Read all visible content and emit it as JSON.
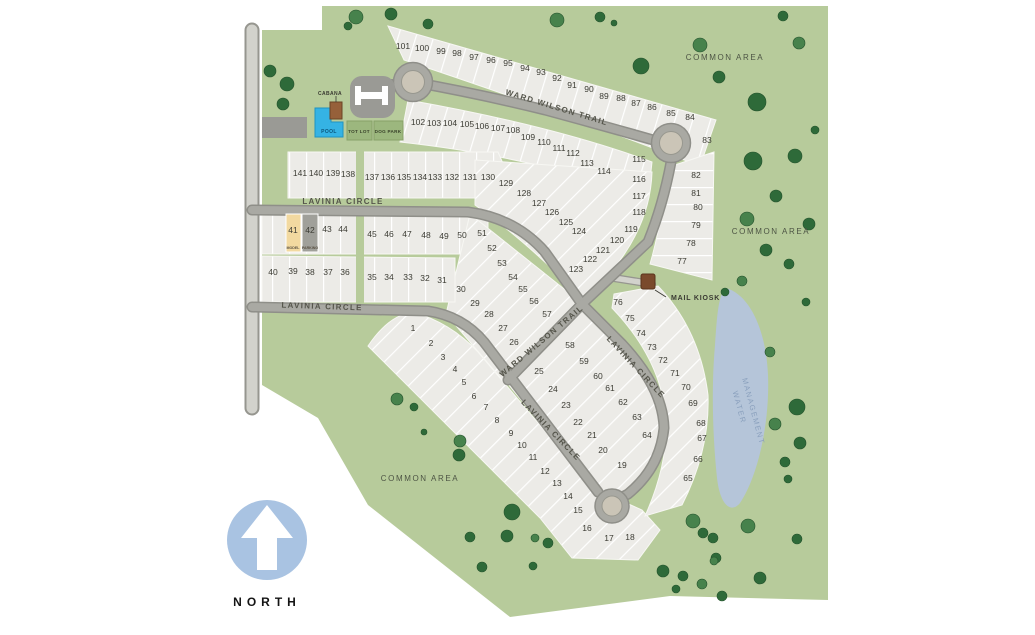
{
  "map": {
    "north_label": "NORTH",
    "streets": [
      {
        "label": "WARD WILSON TRAIL"
      },
      {
        "label": "WARD WILSON TRAIL"
      },
      {
        "label": "LAVINIA CIRCLE"
      },
      {
        "label": "LAVINIA CIRCLE"
      },
      {
        "label": "LAVINIA CIRCLE"
      },
      {
        "label": "LAVINIA CIRCLE"
      }
    ],
    "areas": [
      {
        "label": "COMMON AREA"
      },
      {
        "label": "COMMON AREA"
      },
      {
        "label": "COMMON AREA"
      }
    ],
    "water": {
      "line1": "WATER",
      "line2": "MANAGEMENT"
    },
    "amenities": {
      "cabana": "CABANA",
      "pool": "POOL",
      "tot_lot": "TOT LOT",
      "dog_park": "DOG PARK",
      "mail_kiosk": "MAIL KIOSK"
    },
    "special_lots": {
      "model_label": "MODEL",
      "parking_label": "PARKING"
    },
    "lots_nxy": [
      [
        1,
        413,
        328
      ],
      [
        2,
        431,
        343
      ],
      [
        3,
        443,
        357
      ],
      [
        4,
        455,
        369
      ],
      [
        5,
        464,
        382
      ],
      [
        6,
        474,
        396
      ],
      [
        7,
        486,
        407
      ],
      [
        8,
        497,
        420
      ],
      [
        9,
        511,
        433
      ],
      [
        10,
        522,
        445
      ],
      [
        11,
        533,
        457
      ],
      [
        12,
        545,
        471
      ],
      [
        13,
        557,
        483
      ],
      [
        14,
        568,
        496
      ],
      [
        15,
        578,
        510
      ],
      [
        16,
        587,
        528
      ],
      [
        17,
        609,
        538
      ],
      [
        18,
        630,
        537
      ],
      [
        19,
        622,
        465
      ],
      [
        20,
        603,
        450
      ],
      [
        21,
        592,
        435
      ],
      [
        22,
        578,
        422
      ],
      [
        23,
        566,
        405
      ],
      [
        24,
        553,
        389
      ],
      [
        25,
        539,
        371
      ],
      [
        26,
        514,
        342
      ],
      [
        27,
        503,
        328
      ],
      [
        28,
        489,
        314
      ],
      [
        29,
        475,
        303
      ],
      [
        30,
        461,
        289
      ],
      [
        31,
        442,
        280
      ],
      [
        32,
        425,
        278
      ],
      [
        33,
        408,
        277
      ],
      [
        34,
        389,
        277
      ],
      [
        35,
        372,
        277
      ],
      [
        36,
        345,
        272
      ],
      [
        37,
        328,
        272
      ],
      [
        38,
        310,
        272
      ],
      [
        39,
        293,
        271
      ],
      [
        40,
        273,
        272
      ],
      [
        41,
        293,
        230
      ],
      [
        42,
        310,
        230
      ],
      [
        43,
        327,
        229
      ],
      [
        44,
        343,
        229
      ],
      [
        45,
        372,
        234
      ],
      [
        46,
        389,
        234
      ],
      [
        47,
        407,
        234
      ],
      [
        48,
        426,
        235
      ],
      [
        49,
        444,
        236
      ],
      [
        50,
        462,
        235
      ],
      [
        51,
        482,
        233
      ],
      [
        52,
        492,
        248
      ],
      [
        53,
        502,
        263
      ],
      [
        54,
        513,
        277
      ],
      [
        55,
        523,
        289
      ],
      [
        56,
        534,
        301
      ],
      [
        57,
        547,
        314
      ],
      [
        58,
        570,
        345
      ],
      [
        59,
        584,
        361
      ],
      [
        60,
        598,
        376
      ],
      [
        61,
        610,
        388
      ],
      [
        62,
        623,
        402
      ],
      [
        63,
        637,
        417
      ],
      [
        64,
        647,
        435
      ],
      [
        65,
        688,
        478
      ],
      [
        66,
        698,
        459
      ],
      [
        67,
        702,
        438
      ],
      [
        68,
        701,
        423
      ],
      [
        69,
        693,
        403
      ],
      [
        70,
        686,
        387
      ],
      [
        71,
        675,
        373
      ],
      [
        72,
        663,
        360
      ],
      [
        73,
        652,
        347
      ],
      [
        74,
        641,
        333
      ],
      [
        75,
        630,
        318
      ],
      [
        76,
        618,
        302
      ],
      [
        77,
        682,
        261
      ],
      [
        78,
        691,
        243
      ],
      [
        79,
        696,
        225
      ],
      [
        80,
        698,
        207
      ],
      [
        81,
        696,
        193
      ],
      [
        82,
        696,
        175
      ],
      [
        83,
        707,
        140
      ],
      [
        84,
        690,
        117
      ],
      [
        85,
        671,
        113
      ],
      [
        86,
        652,
        107
      ],
      [
        87,
        636,
        103
      ],
      [
        88,
        621,
        98
      ],
      [
        89,
        604,
        96
      ],
      [
        90,
        589,
        89
      ],
      [
        91,
        572,
        85
      ],
      [
        92,
        557,
        78
      ],
      [
        93,
        541,
        72
      ],
      [
        94,
        525,
        68
      ],
      [
        95,
        508,
        63
      ],
      [
        96,
        491,
        60
      ],
      [
        97,
        474,
        57
      ],
      [
        98,
        457,
        53
      ],
      [
        99,
        441,
        51
      ],
      [
        100,
        422,
        48
      ],
      [
        101,
        403,
        46
      ],
      [
        102,
        418,
        122
      ],
      [
        103,
        434,
        123
      ],
      [
        104,
        450,
        123
      ],
      [
        105,
        467,
        124
      ],
      [
        106,
        482,
        126
      ],
      [
        107,
        498,
        128
      ],
      [
        108,
        513,
        130
      ],
      [
        109,
        528,
        137
      ],
      [
        110,
        544,
        142
      ],
      [
        111,
        559,
        148
      ],
      [
        112,
        573,
        153
      ],
      [
        113,
        587,
        163
      ],
      [
        114,
        604,
        171
      ],
      [
        115,
        639,
        159
      ],
      [
        116,
        639,
        179
      ],
      [
        117,
        639,
        196
      ],
      [
        118,
        639,
        212
      ],
      [
        119,
        631,
        229
      ],
      [
        120,
        617,
        240
      ],
      [
        121,
        603,
        250
      ],
      [
        122,
        590,
        259
      ],
      [
        123,
        576,
        269
      ],
      [
        124,
        579,
        231
      ],
      [
        125,
        566,
        222
      ],
      [
        126,
        552,
        212
      ],
      [
        127,
        539,
        203
      ],
      [
        128,
        524,
        193
      ],
      [
        129,
        506,
        183
      ],
      [
        130,
        488,
        177
      ],
      [
        131,
        470,
        177
      ],
      [
        132,
        452,
        177
      ],
      [
        133,
        435,
        177
      ],
      [
        134,
        420,
        177
      ],
      [
        135,
        404,
        177
      ],
      [
        136,
        388,
        177
      ],
      [
        137,
        372,
        177
      ],
      [
        138,
        348,
        174
      ],
      [
        139,
        333,
        173
      ],
      [
        140,
        316,
        173
      ],
      [
        141,
        300,
        173
      ]
    ],
    "trees_xyr": [
      [
        356,
        17,
        7
      ],
      [
        348,
        26,
        4
      ],
      [
        391,
        14,
        6
      ],
      [
        428,
        24,
        5
      ],
      [
        557,
        20,
        7
      ],
      [
        600,
        17,
        5
      ],
      [
        614,
        23,
        3
      ],
      [
        641,
        66,
        8
      ],
      [
        700,
        45,
        7
      ],
      [
        719,
        77,
        6
      ],
      [
        757,
        102,
        9
      ],
      [
        783,
        16,
        5
      ],
      [
        799,
        43,
        6
      ],
      [
        753,
        161,
        9
      ],
      [
        795,
        156,
        7
      ],
      [
        776,
        196,
        6
      ],
      [
        747,
        219,
        7
      ],
      [
        809,
        224,
        6
      ],
      [
        766,
        250,
        6
      ],
      [
        789,
        264,
        5
      ],
      [
        742,
        281,
        5
      ],
      [
        725,
        292,
        4
      ],
      [
        815,
        130,
        4
      ],
      [
        806,
        302,
        4
      ],
      [
        770,
        352,
        5
      ],
      [
        270,
        71,
        6
      ],
      [
        287,
        84,
        7
      ],
      [
        283,
        104,
        6
      ],
      [
        397,
        399,
        6
      ],
      [
        414,
        407,
        4
      ],
      [
        459,
        455,
        6
      ],
      [
        424,
        432,
        3
      ],
      [
        460,
        441,
        6
      ],
      [
        512,
        512,
        8
      ],
      [
        470,
        537,
        5
      ],
      [
        507,
        536,
        6
      ],
      [
        535,
        538,
        4
      ],
      [
        548,
        543,
        5
      ],
      [
        482,
        567,
        5
      ],
      [
        533,
        566,
        4
      ],
      [
        693,
        521,
        7
      ],
      [
        703,
        533,
        5
      ],
      [
        663,
        571,
        6
      ],
      [
        683,
        576,
        5
      ],
      [
        702,
        584,
        5
      ],
      [
        676,
        589,
        4
      ],
      [
        716,
        558,
        5
      ],
      [
        797,
        407,
        8
      ],
      [
        775,
        424,
        6
      ],
      [
        800,
        443,
        6
      ],
      [
        785,
        462,
        5
      ],
      [
        788,
        479,
        4
      ],
      [
        748,
        526,
        7
      ],
      [
        713,
        538,
        5
      ],
      [
        760,
        578,
        6
      ],
      [
        722,
        596,
        5
      ],
      [
        714,
        561,
        4
      ],
      [
        797,
        539,
        5
      ]
    ],
    "colors": {
      "common_green": "#b7cb9b",
      "parcel_fill": "#ecebe7",
      "road_gray": "#a9a9a3",
      "road_casing": "#8f8f89",
      "cul_de_sac_center": "#cbc5b7",
      "pond_blue": "#b5c5d9",
      "pool_blue": "#35b3e4",
      "north_circle_blue": "#a9c3e2",
      "amenity_green": "#9cb77e",
      "parking_gray": "#9a9a95",
      "kiosk_brown": "#7a4a2c",
      "cabana_brown": "#96603a",
      "model_yellow": "#f2d9a0",
      "tree_green": "#2e6a39",
      "tree_green_alt": "#47824c",
      "text_dark": "#3c3c34"
    }
  }
}
